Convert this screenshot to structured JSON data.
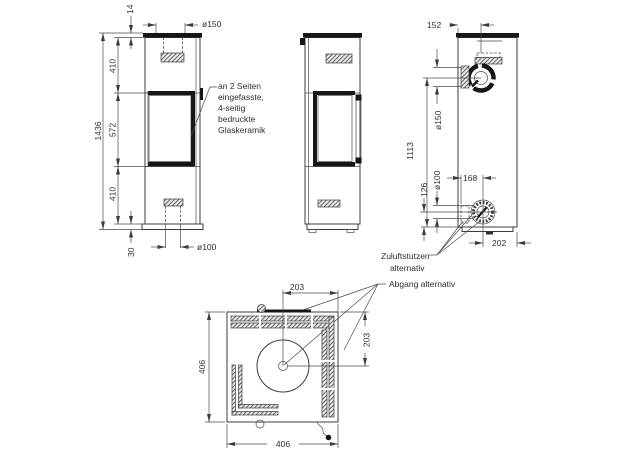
{
  "drawing": {
    "front_view": {
      "dim_top_plate": "14",
      "dim_flue_diameter": "ø150",
      "dim_upper_section": "410",
      "dim_total_height": "1436",
      "dim_glass_section": "572",
      "dim_lower_section": "410",
      "dim_base_height": "30",
      "dim_air_diameter": "ø100",
      "note_glass": {
        "line1": "an 2 Seiten",
        "line2": "eingefasste,",
        "line3": "4-seitig",
        "line4": "bedruckte",
        "line5": "Glaskeramik"
      }
    },
    "rear_view": {
      "dim_flue_offset": "152",
      "dim_flue_diameter": "ø150",
      "dim_flue_height": "1113",
      "dim_air_height": "126",
      "dim_air_diameter": "ø100",
      "dim_air_offset_left": "168",
      "dim_air_offset_right": "202",
      "label_air_inlet": {
        "line1": "Zuluftstutzen",
        "line2": "alternativ"
      },
      "label_flue_alt": "Abgang alternativ"
    },
    "top_view": {
      "dim_center_from_right": "203",
      "dim_center_from_back": "203",
      "dim_width": "406",
      "dim_depth": "406"
    }
  }
}
